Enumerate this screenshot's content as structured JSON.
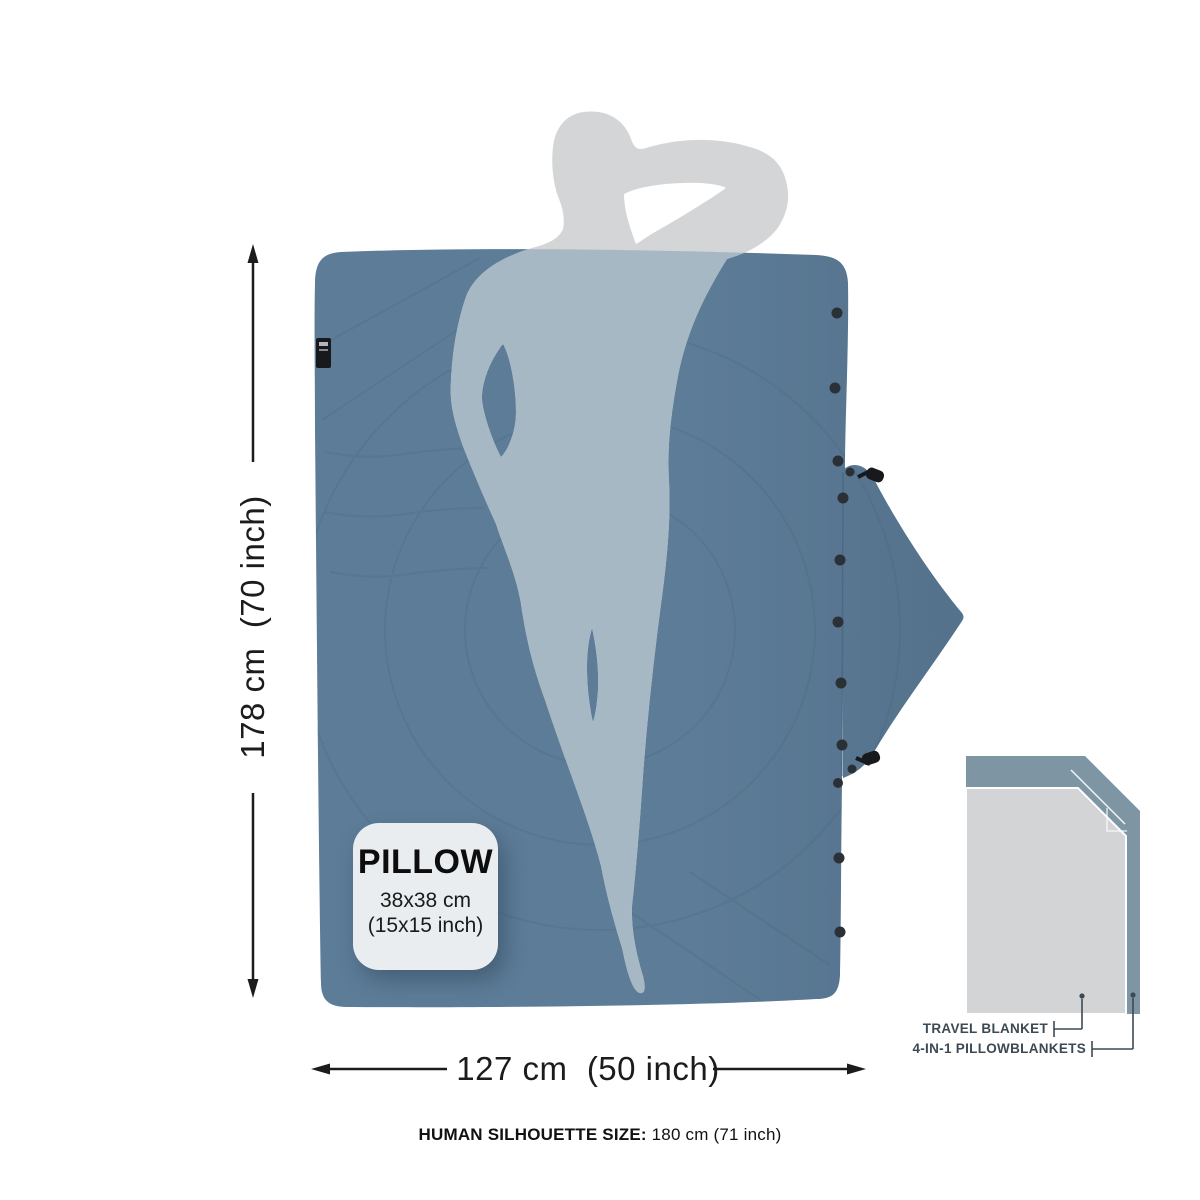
{
  "diagram": {
    "vertical_dimension": "178 cm  (70 inch)",
    "horizontal_dimension": "127 cm  (50 inch)",
    "pillow_card": {
      "title": "PILLOW",
      "size_cm": "38x38 cm",
      "size_inch": "(15x15 inch)"
    },
    "comparison": {
      "travel_blanket": "TRAVEL BLANKET",
      "four_in_one": "4-IN-1 PILLOWBLANKETS"
    },
    "footnote_label": "HUMAN SILHOUETTE SIZE:",
    "footnote_value": " 180 cm (71 inch)",
    "colors": {
      "blanket": "#5d7c97",
      "quilt_seam": "#49677f",
      "silhouette": "#d3d5d7",
      "silhouette_over_blanket": "#a7b8c5",
      "snap": "#2b3036",
      "toggle": "#17191c",
      "dimension_ink": "#1c1c1c",
      "comparison_back": "#7e96a3",
      "comparison_front": "#d2d4d5",
      "leader_ink": "#3d4a54"
    }
  }
}
